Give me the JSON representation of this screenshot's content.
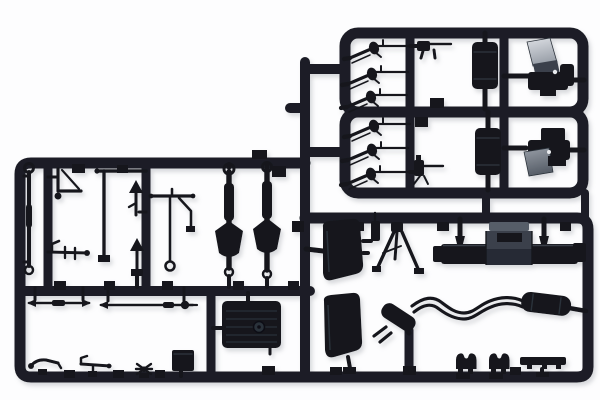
{
  "scene": {
    "type": "product-photo",
    "description": "Black plastic injection-moulded model kit sprue (parts tree) with military vehicle parts photographed on a plain white background",
    "background": "plain white seamless",
    "text_visible": "none"
  },
  "colors": {
    "background": "#fdfdfe",
    "plastic": "#1b1f26",
    "plastic_dark": "#14171c",
    "plastic_mid": "#3a414b",
    "plastic_light": "#565d67",
    "band": "#2c323a",
    "ridge": "#262c34",
    "highlight_silver": "#dde0e5",
    "highlight_gray": "#989ea7",
    "white_dot": "#e9ebee",
    "shadow": "#a9adb4"
  },
  "sprue": {
    "material": "dark grey-black styrene",
    "sections": [
      {
        "name": "upper-right-frame-a",
        "contents": [
          "3 rifles",
          "submachine gun",
          "fuel tank cylinder",
          "cab seat unit with silver top"
        ]
      },
      {
        "name": "upper-right-frame-b",
        "contents": [
          "3 rifles",
          "machine gun with bipod",
          "fuel tank cylinder",
          "cab seat unit with silver panel"
        ]
      },
      {
        "name": "main-frame-upper-left",
        "contents": [
          "pull rod with eyelets",
          "bracket cranks",
          "pedal rod",
          "gear levers",
          "steering column",
          "2 axles with differentials"
        ]
      },
      {
        "name": "main-frame-lower-left",
        "contents": [
          "2 tie rods",
          "ribbed radiator tank",
          "handbrake lever",
          "linkage",
          "rotor cross",
          "battery box"
        ]
      },
      {
        "name": "main-frame-right",
        "contents": [
          "2 seat backs",
          "machine gun",
          "tripod",
          "engine assembly",
          "twin-pipe exhaust with mufflers",
          "2 saddle clamps",
          "mounting bar"
        ]
      }
    ],
    "part_count_visible": 40
  }
}
